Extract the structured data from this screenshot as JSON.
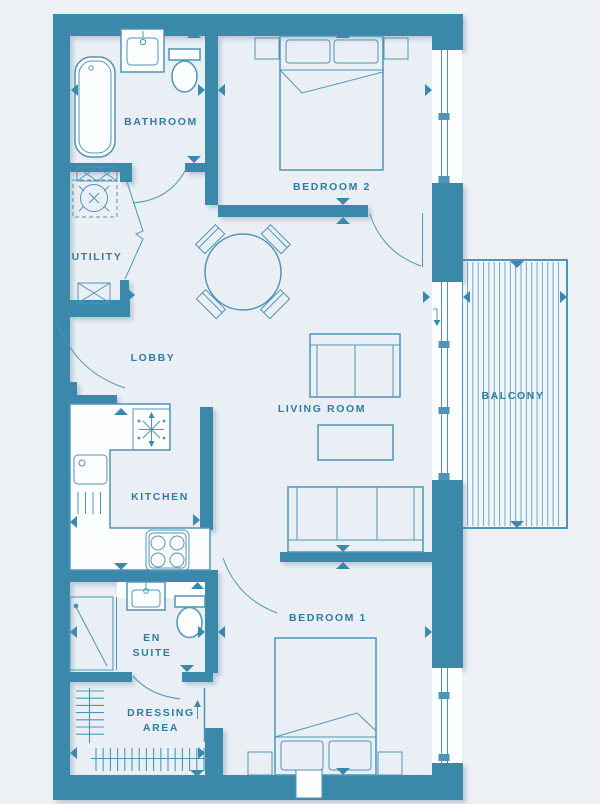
{
  "plan": {
    "title": "Apartment floor plan",
    "rooms": {
      "bathroom": "BATHROOM",
      "utility": "UTILITY",
      "lobby": "LOBBY",
      "kitchen": "KITCHEN",
      "living_room": "LIVING ROOM",
      "balcony": "BALCONY",
      "bedroom2": "BEDROOM 2",
      "bedroom1": "BEDROOM 1",
      "en_suite_line1": "EN",
      "en_suite_line2": "SUITE",
      "dressing_line1": "DRESSING",
      "dressing_line2": "AREA"
    },
    "colors": {
      "wall": "#3a89aa",
      "line": "#4e95b5",
      "label": "#2e7ca0",
      "background": "#edf1f6",
      "floor": "#e9eff5",
      "fixture": "#fdfeff",
      "balcony_floor": "#f2f6fa"
    }
  }
}
